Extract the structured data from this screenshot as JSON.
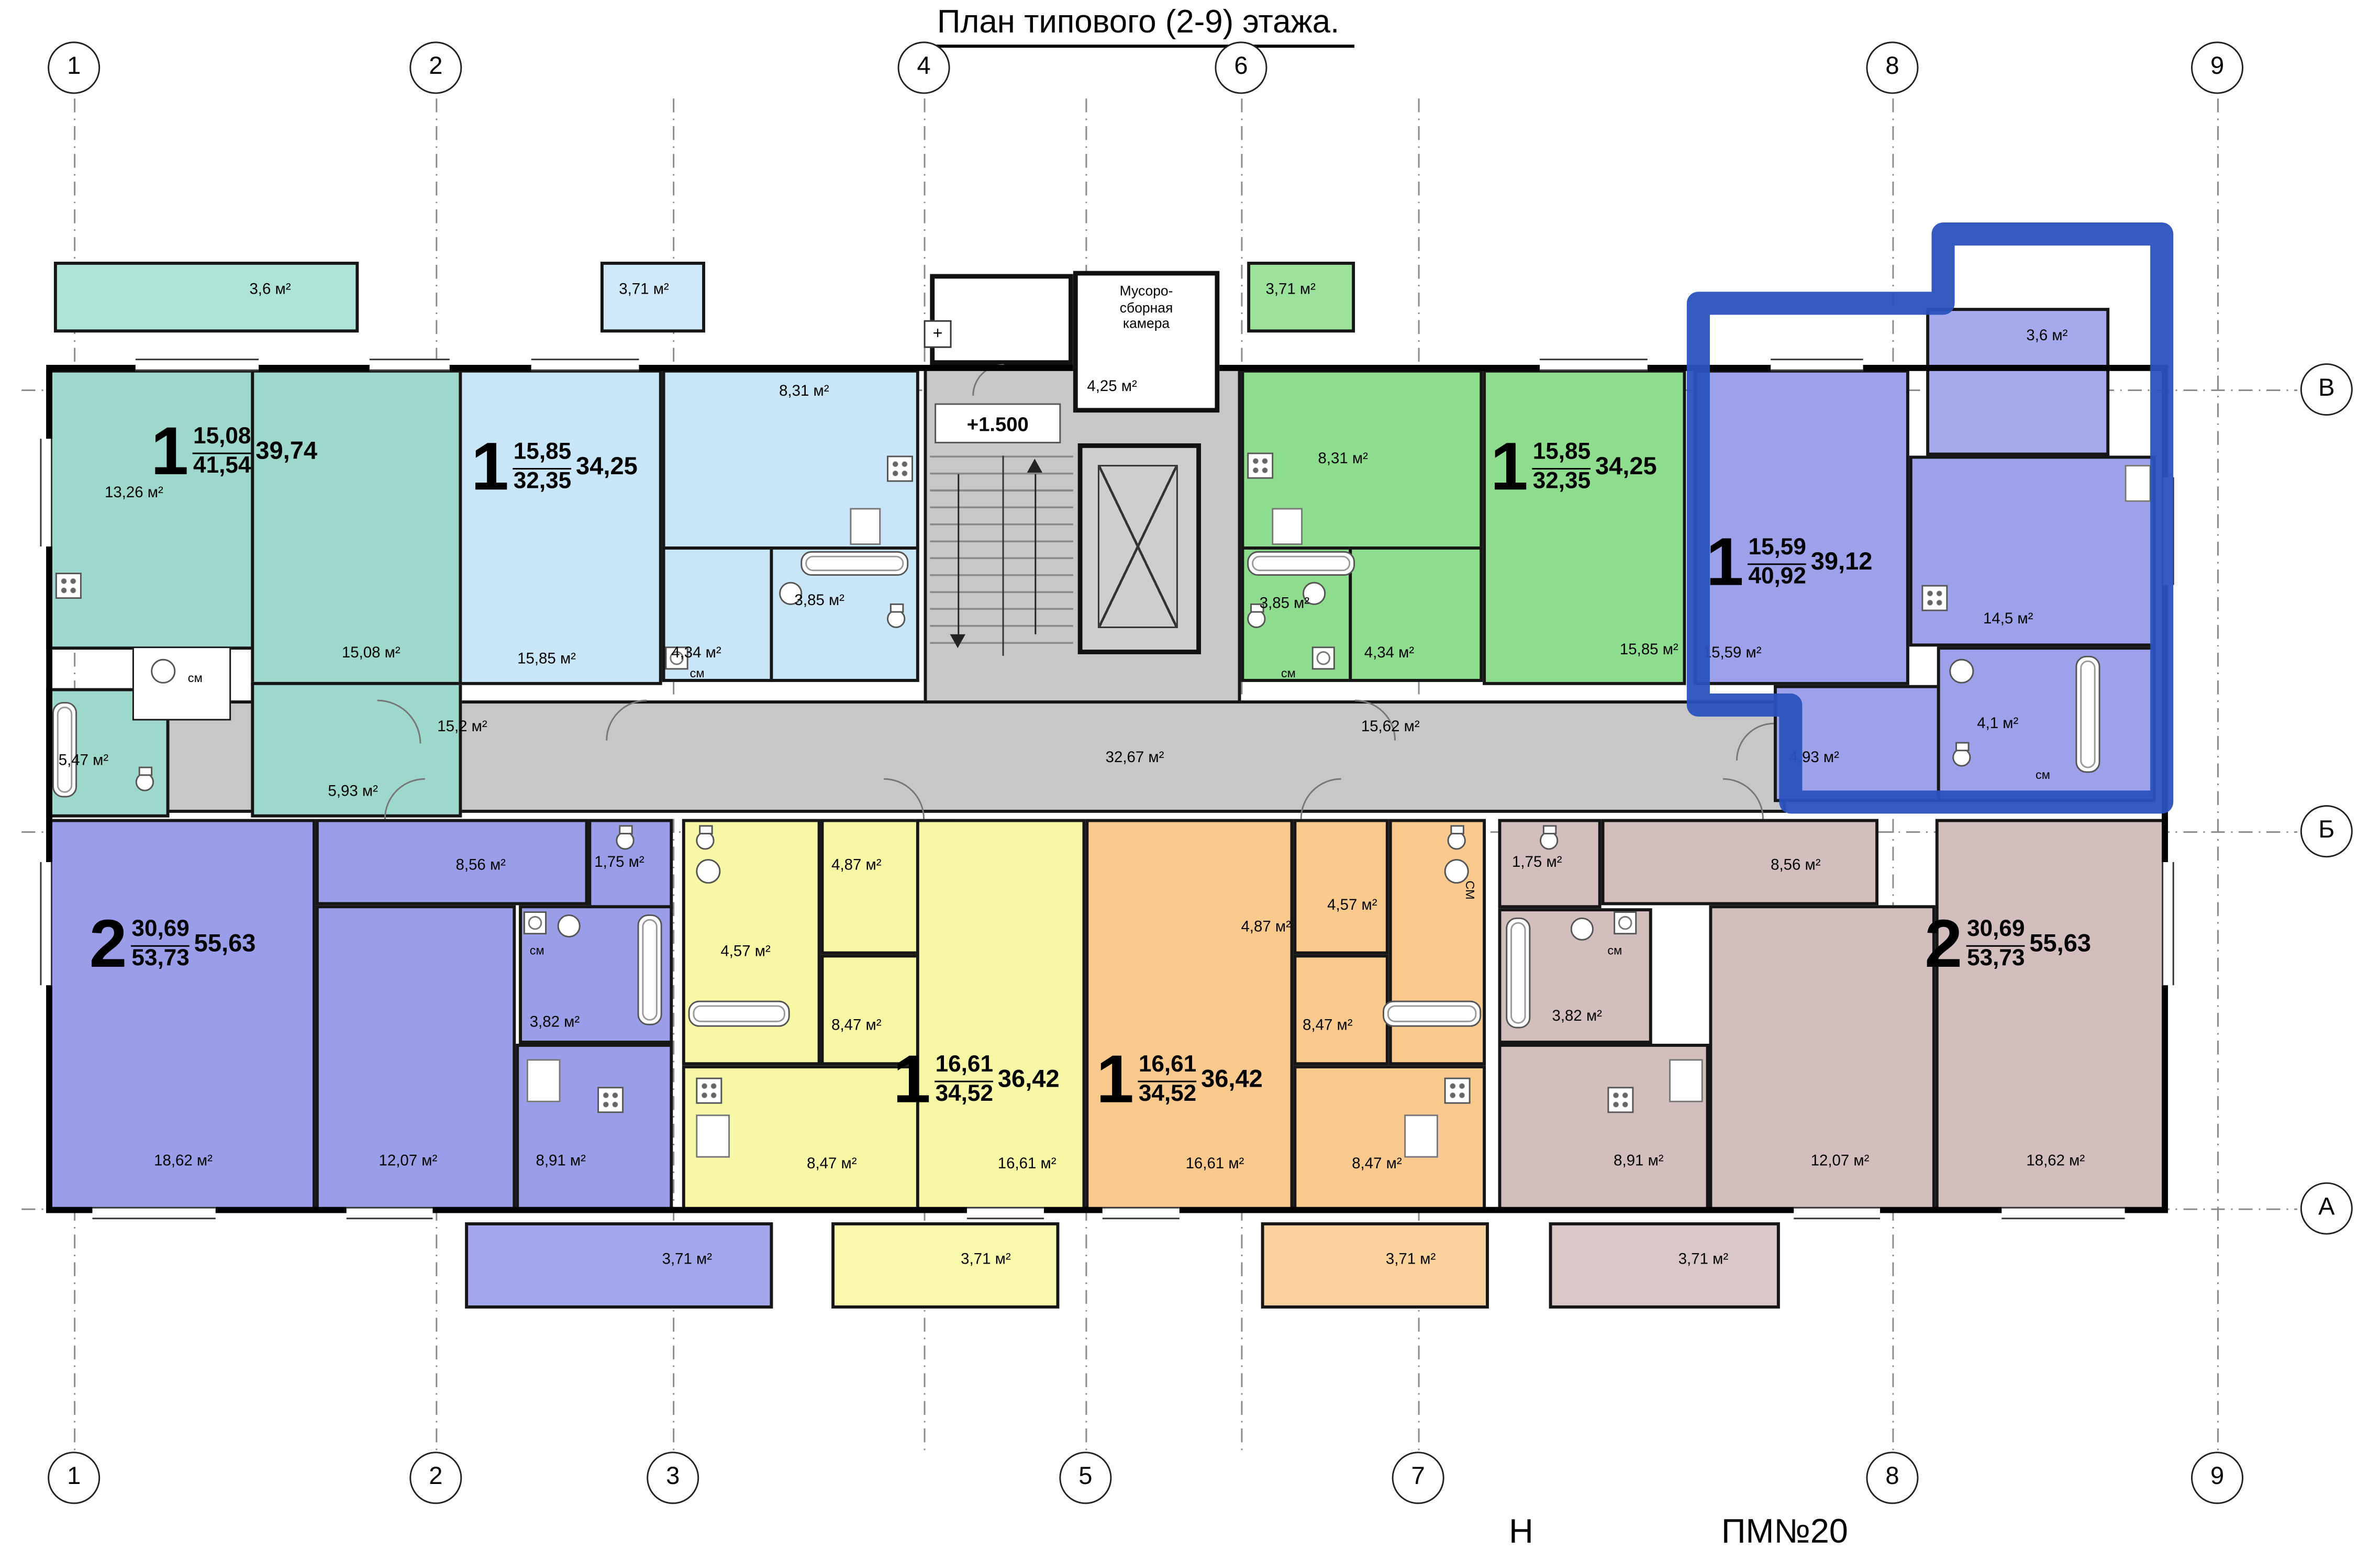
{
  "title": "План типового (2-9) этажа.",
  "axes": {
    "top": [
      "1",
      "2",
      "4",
      "6",
      "8",
      "9"
    ],
    "bottom": [
      "1",
      "2",
      "3",
      "5",
      "7",
      "8",
      "9"
    ],
    "right": [
      "В",
      "Б",
      "А"
    ]
  },
  "core": {
    "level": "+1.500",
    "chute": "+",
    "garbage": [
      "Мусоро-",
      "сборная",
      "камера"
    ],
    "garbage_area": "4,25 м²"
  },
  "corridors": {
    "left": "15,2 м²",
    "center": "32,67 м²",
    "right": "15,62 м²"
  },
  "apts": {
    "teal": {
      "num": "1",
      "a1": "15,08",
      "a2": "41,54",
      "a3": "39,74",
      "balcony": "3,6 м²",
      "kitchen": "13,26 м²",
      "living": "15,08 м²",
      "bath": "5,47 м²",
      "hall": "5,93 м²",
      "wm": "см"
    },
    "blue": {
      "num": "1",
      "a1": "15,85",
      "a2": "32,35",
      "a3": "34,25",
      "balcony": "3,71 м²",
      "kitchen": "8,31 м²",
      "living": "15,85 м²",
      "hall": "4,34 м²",
      "bath": "3,85 м²",
      "wm": "см"
    },
    "green": {
      "num": "1",
      "a1": "15,85",
      "a2": "32,35",
      "a3": "34,25",
      "balcony": "3,71 м²",
      "kitchen": "8,31 м²",
      "living": "15,85 м²",
      "hall": "4,34 м²",
      "bath": "3,85 м²",
      "wm": "см"
    },
    "violet": {
      "num": "1",
      "a1": "15,59",
      "a2": "40,92",
      "a3": "39,12",
      "balcony": "3,6 м²",
      "living": "15,59 м²",
      "kitchen": "14,5 м²",
      "hall": "4,93 м²",
      "bath": "4,1 м²",
      "wm": "см"
    },
    "purple2": {
      "num": "2",
      "a1": "30,69",
      "a2": "53,73",
      "a3": "55,63",
      "living": "18,62 м²",
      "bedroom": "12,07 м²",
      "kitchen": "8,91 м²",
      "hall": "8,56 м²",
      "wc": "1,75 м²",
      "bath": "3,82 м²",
      "wm": "см",
      "balcony": "3,71 м²"
    },
    "yellow": {
      "num": "1",
      "a1": "16,61",
      "a2": "34,52",
      "a3": "36,42",
      "living": "16,61 м²",
      "kitchen": "8,47 м²",
      "corridor": "8,47 м²",
      "hall": "4,87 м²",
      "bath": "4,57 м²",
      "balcony": "3,71 м²"
    },
    "orange": {
      "num": "1",
      "a1": "16,61",
      "a2": "34,52",
      "a3": "36,42",
      "living": "16,61 м²",
      "kitchen": "8,47 м²",
      "corridor": "8,47 м²",
      "hall": "4,87 м²",
      "bath": "4,57 м²",
      "wm": "СМ",
      "balcony": "3,71 м²"
    },
    "beige": {
      "num": "2",
      "a1": "30,69",
      "a2": "53,73",
      "a3": "55,63",
      "living": "18,62 м²",
      "bedroom": "12,07 м²",
      "kitchen": "8,91 м²",
      "hall": "8,56 м²",
      "wc": "1,75 м²",
      "bath": "3,82 м²",
      "wm": "см",
      "balcony": "3,71 м²"
    }
  },
  "footer": {
    "left": "Н",
    "right": "ПМ№20"
  },
  "colors": {
    "highlight": "#2a52be"
  }
}
